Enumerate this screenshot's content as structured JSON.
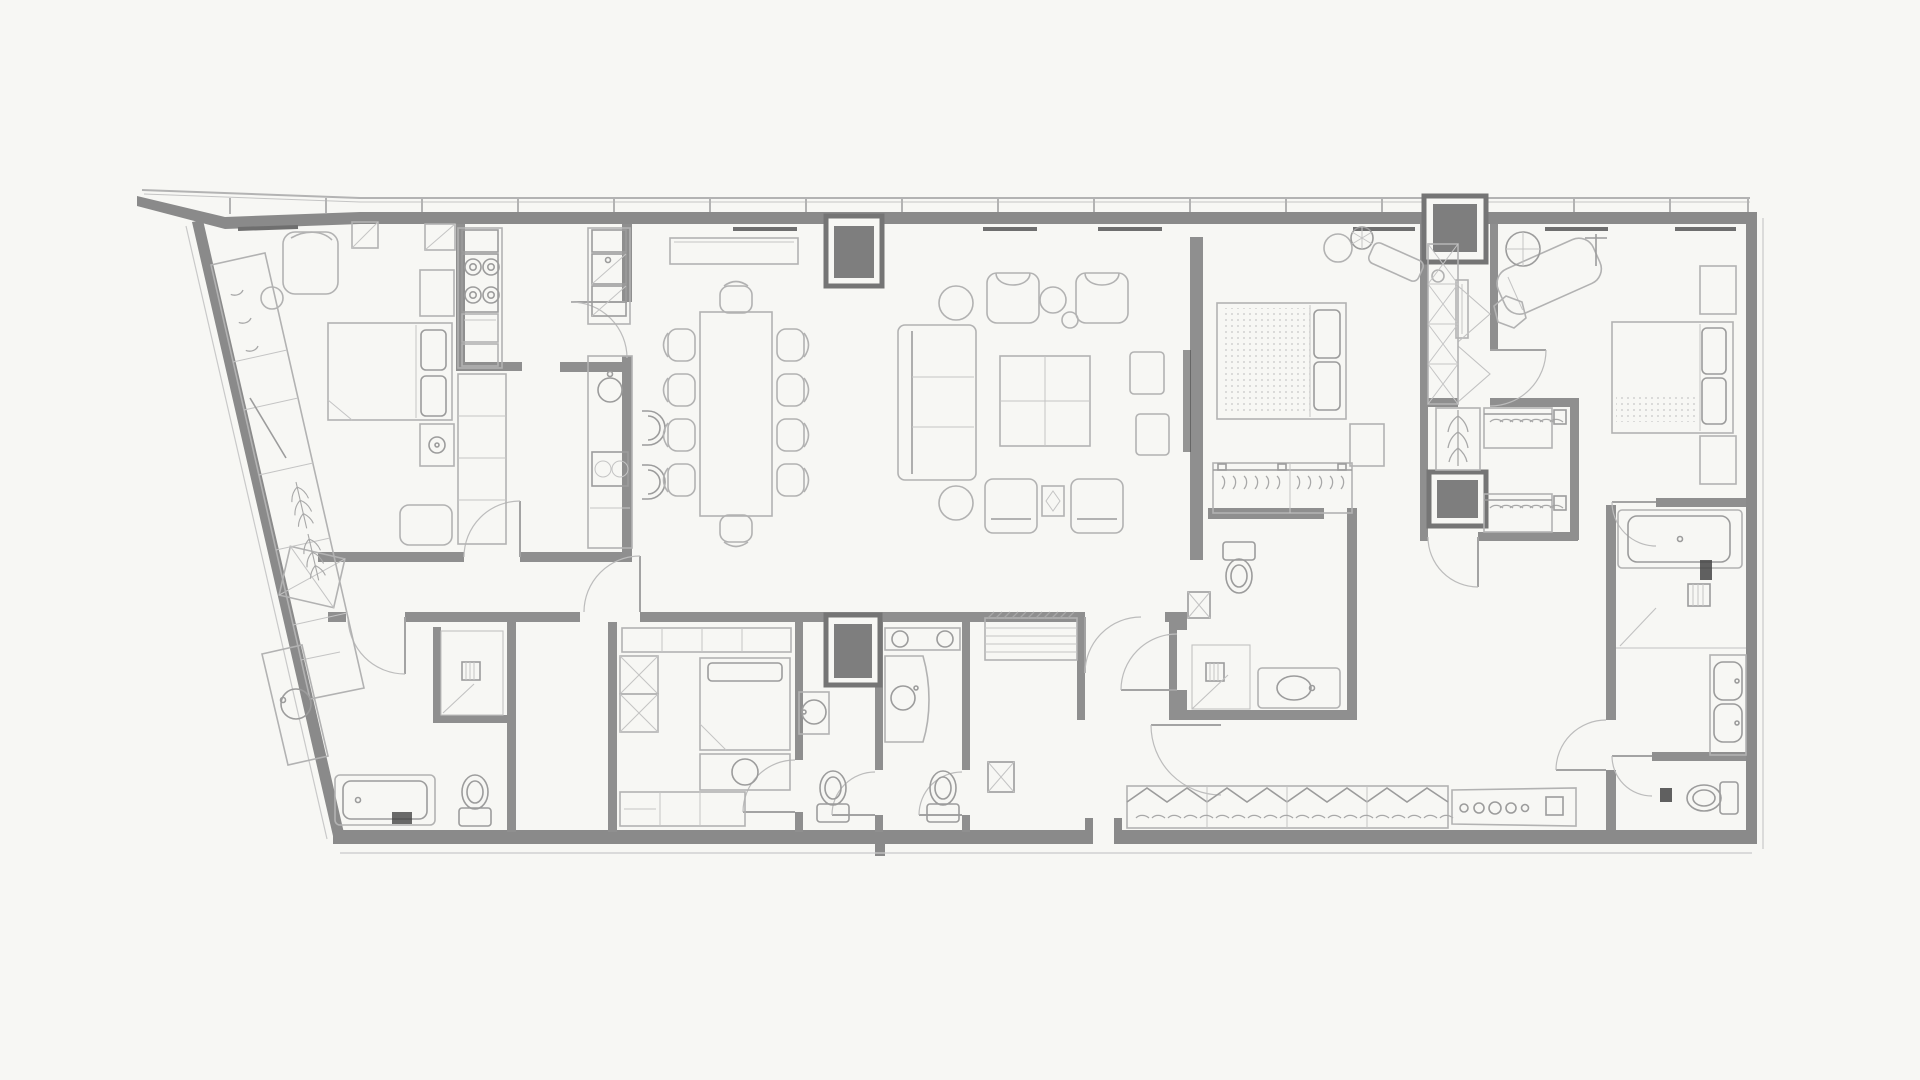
{
  "title": "Residential apartment floor plan – architectural line drawing, no text labels",
  "canvas": {
    "width": 1920,
    "height": 1080
  },
  "style": {
    "background": "#f7f7f4",
    "wall_color": "#8a8a8a",
    "furniture_line": "#b2b2b2",
    "detail_line": "#9c9c9c",
    "shaft_fill": "#7e7e7e",
    "shaft_frame": "#757575",
    "accent_dark": "#454545",
    "glass_line": "#c4c4c4"
  },
  "structure": {
    "exterior": [
      "curtain-wall top with mullions",
      "angled west wall",
      "flat south wall",
      "east wall"
    ],
    "service_shafts": 4,
    "door_swings": 15,
    "window_mullions": 17,
    "sill_vents": 7
  },
  "rooms": [
    {
      "id": "corner-bedroom",
      "name": "Corner bedroom (north-west)",
      "fixtures": [
        "double bed with two pillows",
        "armchair",
        "round side table",
        "dresser",
        "nightstand with lamp",
        "wall cabinet",
        "bench",
        "angled shoe cabinet"
      ]
    },
    {
      "id": "wardrobe-wall",
      "name": "Angled wardrobe wall",
      "fixtures": [
        "coat hooks section",
        "shelf rod",
        "long-hang garment section",
        "open shelving",
        "drawer unit"
      ]
    },
    {
      "id": "kitchen",
      "name": "Galley kitchen",
      "fixtures": [
        "extractor hood",
        "four-burner cooktop",
        "oven",
        "double sink with drainer",
        "tall cabinets",
        "island counter",
        "round prep sink",
        "small appliance",
        "two bar stools"
      ]
    },
    {
      "id": "dining",
      "name": "Dining area",
      "fixtures": [
        "dining table for ten",
        "10 chairs",
        "long sideboard"
      ]
    },
    {
      "id": "living",
      "name": "Living area",
      "fixtures": [
        "three-seat sofa",
        "square coffee table",
        "two armchairs",
        "two round side tables",
        "two round poufs",
        "two upholstered ottomans",
        "occasional table",
        "two patterned stools",
        "TV on partition wall"
      ]
    },
    {
      "id": "master-bedroom",
      "name": "Master bedroom",
      "fixtures": [
        "double bed with quilted mattress",
        "reading nook with round table and plant",
        "rotated bench",
        "nightstand",
        "open hanging rail with hangers"
      ]
    },
    {
      "id": "master-bathroom",
      "name": "Master bathroom",
      "fixtures": [
        "wall-hung toilet",
        "shower with floor drain",
        "vanity with basin",
        "service duct"
      ]
    },
    {
      "id": "guest-bathroom",
      "name": "Guest bathroom (south-west)",
      "fixtures": [
        "bathtub with bath mat",
        "shower room with drain",
        "toilet",
        "angled vanity with round basin"
      ]
    },
    {
      "id": "hall",
      "name": "Hall and vestibule",
      "fixtures": [
        "door swings",
        "open circulation"
      ]
    },
    {
      "id": "staff-room",
      "name": "Staff bedroom",
      "fixtures": [
        "single bed",
        "desk with chair",
        "tall cabinet with cross fronts",
        "media cabinet",
        "wardrobe counter"
      ]
    },
    {
      "id": "staff-bathroom",
      "name": "Staff bathroom",
      "fixtures": [
        "round basin",
        "toilet"
      ]
    },
    {
      "id": "powder-bathroom",
      "name": "Second bathroom",
      "fixtures": [
        "double-basin counter",
        "curved vanity with round basin",
        "toilet",
        "service duct"
      ]
    },
    {
      "id": "entry-corridor",
      "name": "Entry corridor",
      "fixtures": [
        "linen shelf unit",
        "entry door swing"
      ]
    },
    {
      "id": "east-bedroom",
      "name": "East bedroom",
      "fixtures": [
        "double bed with runner",
        "two nightstands",
        "rotated chaise longue",
        "round standing mirror",
        "valet stand",
        "dressing stool",
        "console"
      ]
    },
    {
      "id": "walk-in-closet",
      "name": "Walk-in closet",
      "fixtures": [
        "two hanging rails with hangers",
        "long-hang column",
        "service shaft",
        "end shelving"
      ]
    },
    {
      "id": "dressing-corridor",
      "name": "Dressing corridor",
      "fixtures": [
        "long garment racks with covers",
        "vanity counter with five round accessories",
        "accessory tray"
      ]
    },
    {
      "id": "ensuite-bathroom",
      "name": "En-suite bathroom (south-east)",
      "fixtures": [
        "bathtub",
        "shower zone with drain",
        "double-basin vanity",
        "WC room with toilet",
        "dark bath mats"
      ]
    }
  ]
}
